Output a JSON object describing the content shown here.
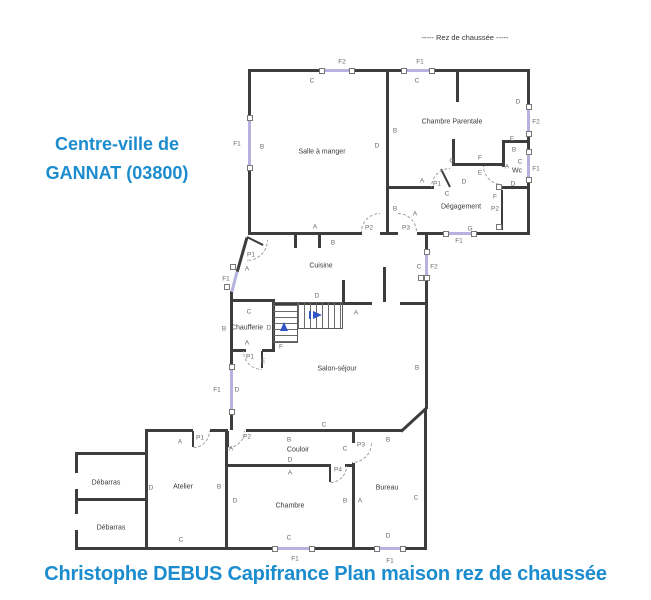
{
  "header": {
    "floor_label": "----- Rez de chaussée -----"
  },
  "location": {
    "line1": "Centre-ville de",
    "line2": "GANNAT (03800)"
  },
  "footer": {
    "caption": "Christophe DEBUS Capifrance Plan maison rez de chaussée"
  },
  "colors": {
    "wall": "#3d3d3d",
    "window": "#b5b2df",
    "accent_blue": "#1b8cce",
    "stair_arrow": "#3356c6",
    "label": "#6a6a6a"
  },
  "plan": {
    "rooms": [
      {
        "name": "Salle à manger",
        "x": 322,
        "y": 152
      },
      {
        "name": "Chambre Parentale",
        "x": 452,
        "y": 122
      },
      {
        "name": "Wc",
        "x": 517,
        "y": 171
      },
      {
        "name": "Dégagement",
        "x": 461,
        "y": 207
      },
      {
        "name": "Cuisine",
        "x": 321,
        "y": 266
      },
      {
        "name": "Chaufferie",
        "x": 247,
        "y": 328
      },
      {
        "name": "Salon-séjour",
        "x": 337,
        "y": 369
      },
      {
        "name": "Couloir",
        "x": 298,
        "y": 450
      },
      {
        "name": "Atelier",
        "x": 183,
        "y": 487
      },
      {
        "name": "Chambre",
        "x": 290,
        "y": 506
      },
      {
        "name": "Bureau",
        "x": 387,
        "y": 488
      },
      {
        "name": "Débarras",
        "x": 106,
        "y": 483
      },
      {
        "name": "Débarras",
        "x": 111,
        "y": 528
      }
    ],
    "labels": [
      {
        "t": "C",
        "x": 312,
        "y": 81
      },
      {
        "t": "F2",
        "x": 342,
        "y": 62
      },
      {
        "t": "F1",
        "x": 420,
        "y": 62
      },
      {
        "t": "C",
        "x": 417,
        "y": 81
      },
      {
        "t": "F1",
        "x": 237,
        "y": 144
      },
      {
        "t": "B",
        "x": 262,
        "y": 147
      },
      {
        "t": "D",
        "x": 377,
        "y": 146
      },
      {
        "t": "A",
        "x": 315,
        "y": 227
      },
      {
        "t": "B",
        "x": 333,
        "y": 243
      },
      {
        "t": "B",
        "x": 395,
        "y": 131
      },
      {
        "t": "D",
        "x": 518,
        "y": 102
      },
      {
        "t": "F2",
        "x": 536,
        "y": 122
      },
      {
        "t": "E",
        "x": 512,
        "y": 139
      },
      {
        "t": "B",
        "x": 514,
        "y": 150
      },
      {
        "t": "C",
        "x": 520,
        "y": 162
      },
      {
        "t": "A",
        "x": 507,
        "y": 167
      },
      {
        "t": "D",
        "x": 513,
        "y": 184
      },
      {
        "t": "F1",
        "x": 536,
        "y": 169
      },
      {
        "t": "G",
        "x": 452,
        "y": 161
      },
      {
        "t": "F",
        "x": 480,
        "y": 158
      },
      {
        "t": "E",
        "x": 480,
        "y": 173
      },
      {
        "t": "D",
        "x": 464,
        "y": 182
      },
      {
        "t": "A",
        "x": 422,
        "y": 181
      },
      {
        "t": "P1",
        "x": 437,
        "y": 184
      },
      {
        "t": "C",
        "x": 447,
        "y": 194
      },
      {
        "t": "F",
        "x": 495,
        "y": 197
      },
      {
        "t": "P2",
        "x": 495,
        "y": 209
      },
      {
        "t": "B",
        "x": 395,
        "y": 209
      },
      {
        "t": "A",
        "x": 415,
        "y": 214
      },
      {
        "t": "P2",
        "x": 369,
        "y": 228
      },
      {
        "t": "P3",
        "x": 406,
        "y": 228
      },
      {
        "t": "G",
        "x": 470,
        "y": 229
      },
      {
        "t": "F1",
        "x": 459,
        "y": 241
      },
      {
        "t": "F2",
        "x": 434,
        "y": 267
      },
      {
        "t": "C",
        "x": 419,
        "y": 267
      },
      {
        "t": "P1",
        "x": 251,
        "y": 255
      },
      {
        "t": "A",
        "x": 247,
        "y": 269
      },
      {
        "t": "F1",
        "x": 226,
        "y": 279
      },
      {
        "t": "D",
        "x": 317,
        "y": 296
      },
      {
        "t": "C",
        "x": 249,
        "y": 312
      },
      {
        "t": "B",
        "x": 224,
        "y": 329
      },
      {
        "t": "D",
        "x": 269,
        "y": 328
      },
      {
        "t": "A",
        "x": 247,
        "y": 343
      },
      {
        "t": "P1",
        "x": 250,
        "y": 357
      },
      {
        "t": "F",
        "x": 281,
        "y": 347
      },
      {
        "t": "E",
        "x": 263,
        "y": 361
      },
      {
        "t": "A",
        "x": 356,
        "y": 313
      },
      {
        "t": "B",
        "x": 417,
        "y": 368
      },
      {
        "t": "C",
        "x": 324,
        "y": 425
      },
      {
        "t": "D",
        "x": 237,
        "y": 390
      },
      {
        "t": "F1",
        "x": 217,
        "y": 390
      },
      {
        "t": "A",
        "x": 180,
        "y": 442
      },
      {
        "t": "P1",
        "x": 200,
        "y": 438
      },
      {
        "t": "A",
        "x": 231,
        "y": 449
      },
      {
        "t": "P2",
        "x": 247,
        "y": 437
      },
      {
        "t": "B",
        "x": 289,
        "y": 440
      },
      {
        "t": "D",
        "x": 290,
        "y": 460
      },
      {
        "t": "A",
        "x": 290,
        "y": 473
      },
      {
        "t": "P4",
        "x": 338,
        "y": 470
      },
      {
        "t": "C",
        "x": 345,
        "y": 449
      },
      {
        "t": "P3",
        "x": 361,
        "y": 445
      },
      {
        "t": "B",
        "x": 388,
        "y": 440
      },
      {
        "t": "D",
        "x": 151,
        "y": 488
      },
      {
        "t": "B",
        "x": 219,
        "y": 487
      },
      {
        "t": "C",
        "x": 181,
        "y": 540
      },
      {
        "t": "D",
        "x": 235,
        "y": 501
      },
      {
        "t": "B",
        "x": 345,
        "y": 501
      },
      {
        "t": "C",
        "x": 289,
        "y": 538
      },
      {
        "t": "F1",
        "x": 295,
        "y": 559
      },
      {
        "t": "A",
        "x": 360,
        "y": 501
      },
      {
        "t": "C",
        "x": 416,
        "y": 498
      },
      {
        "t": "D",
        "x": 388,
        "y": 536
      },
      {
        "t": "F1",
        "x": 390,
        "y": 561
      }
    ],
    "walls": [
      [
        248,
        69,
        282,
        3
      ],
      [
        248,
        69,
        3,
        166
      ],
      [
        527,
        69,
        3,
        166
      ],
      [
        248,
        232,
        114,
        3
      ],
      [
        380,
        232,
        18,
        3
      ],
      [
        417,
        232,
        113,
        3
      ],
      [
        386,
        69,
        3,
        166
      ],
      [
        386,
        186,
        48,
        3
      ],
      [
        452,
        139,
        3,
        27
      ],
      [
        452,
        163,
        53,
        3
      ],
      [
        502,
        140,
        26,
        3
      ],
      [
        502,
        140,
        3,
        27
      ],
      [
        502,
        186,
        26,
        3
      ],
      [
        456,
        69,
        3,
        33
      ],
      [
        501,
        190,
        2,
        40
      ],
      [
        294,
        235,
        3,
        13
      ],
      [
        318,
        235,
        3,
        13
      ],
      [
        383,
        267,
        3,
        35
      ],
      [
        275,
        302,
        97,
        3
      ],
      [
        400,
        302,
        27,
        3
      ],
      [
        342,
        280,
        3,
        22
      ],
      [
        425,
        232,
        3,
        20
      ],
      [
        425,
        278,
        3,
        131
      ],
      [
        230,
        291,
        3,
        139
      ],
      [
        232,
        299,
        43,
        3
      ],
      [
        272,
        299,
        3,
        53
      ],
      [
        232,
        349,
        14,
        3
      ],
      [
        262,
        349,
        13,
        3
      ],
      [
        261,
        351,
        2,
        17
      ],
      [
        145,
        429,
        48,
        3
      ],
      [
        210,
        429,
        18,
        3
      ],
      [
        246,
        429,
        156,
        3
      ],
      [
        145,
        429,
        3,
        121
      ],
      [
        225,
        429,
        3,
        121
      ],
      [
        225,
        464,
        106,
        3
      ],
      [
        345,
        464,
        7,
        3
      ],
      [
        352,
        429,
        3,
        14
      ],
      [
        352,
        463,
        3,
        87
      ],
      [
        424,
        409,
        3,
        141
      ],
      [
        75,
        547,
        352,
        3
      ],
      [
        75,
        452,
        73,
        3
      ],
      [
        75,
        498,
        73,
        3
      ],
      [
        75,
        452,
        3,
        21
      ],
      [
        75,
        489,
        3,
        25
      ],
      [
        75,
        530,
        3,
        20
      ],
      [
        227,
        431,
        2,
        16
      ],
      [
        329,
        466,
        2,
        16
      ],
      [
        192,
        431,
        2,
        16
      ]
    ],
    "lines": [
      {
        "x1": 247,
        "y1": 237,
        "x2": 237,
        "y2": 272,
        "style": "wall"
      },
      {
        "x1": 247,
        "y1": 237,
        "x2": 263,
        "y2": 245,
        "style": "leaf"
      },
      {
        "x1": 401,
        "y1": 431,
        "x2": 426,
        "y2": 408,
        "style": "wall"
      },
      {
        "x1": 450,
        "y1": 187,
        "x2": 441,
        "y2": 169,
        "style": "leaf"
      },
      {
        "x1": 237,
        "y1": 271,
        "x2": 232,
        "y2": 291,
        "style": "window"
      }
    ],
    "windows": [
      {
        "x": 322,
        "y": 69,
        "w": 30,
        "h": 3
      },
      {
        "x": 404,
        "y": 69,
        "w": 28,
        "h": 3
      },
      {
        "x": 248,
        "y": 118,
        "w": 3,
        "h": 50
      },
      {
        "x": 527,
        "y": 107,
        "w": 3,
        "h": 27
      },
      {
        "x": 527,
        "y": 152,
        "w": 3,
        "h": 28
      },
      {
        "x": 446,
        "y": 232,
        "w": 28,
        "h": 3
      },
      {
        "x": 425,
        "y": 252,
        "w": 3,
        "h": 26
      },
      {
        "x": 230,
        "y": 367,
        "w": 3,
        "h": 45
      },
      {
        "x": 275,
        "y": 547,
        "w": 37,
        "h": 3
      },
      {
        "x": 377,
        "y": 547,
        "w": 26,
        "h": 3
      }
    ],
    "doors": [
      {
        "x": 361,
        "y": 213,
        "s": 19,
        "q": "tl"
      },
      {
        "x": 398,
        "y": 213,
        "s": 19,
        "q": "tr"
      },
      {
        "x": 431,
        "y": 168,
        "s": 19,
        "q": "tl"
      },
      {
        "x": 483,
        "y": 166,
        "s": 19,
        "q": "bl"
      },
      {
        "x": 247,
        "y": 240,
        "s": 21,
        "q": "br"
      },
      {
        "x": 243,
        "y": 351,
        "s": 19,
        "q": "bl"
      },
      {
        "x": 228,
        "y": 431,
        "s": 17,
        "q": "br"
      },
      {
        "x": 330,
        "y": 466,
        "s": 17,
        "q": "br"
      },
      {
        "x": 352,
        "y": 443,
        "s": 20,
        "q": "br"
      },
      {
        "x": 193,
        "y": 431,
        "s": 17,
        "q": "br"
      }
    ],
    "joints": [
      [
        421,
        278
      ],
      [
        499,
        187
      ],
      [
        499,
        227
      ],
      [
        233,
        267
      ],
      [
        227,
        287
      ]
    ],
    "stairs": [
      {
        "x": 273,
        "y": 302,
        "w": 25,
        "h": 41,
        "hatch": "h"
      },
      {
        "x": 297,
        "y": 302,
        "w": 46,
        "h": 27,
        "hatch": "v"
      }
    ],
    "arrows": [
      {
        "cx": 284,
        "cy": 322,
        "dir": "up"
      },
      {
        "cx": 317,
        "cy": 311,
        "dir": "right"
      }
    ]
  }
}
